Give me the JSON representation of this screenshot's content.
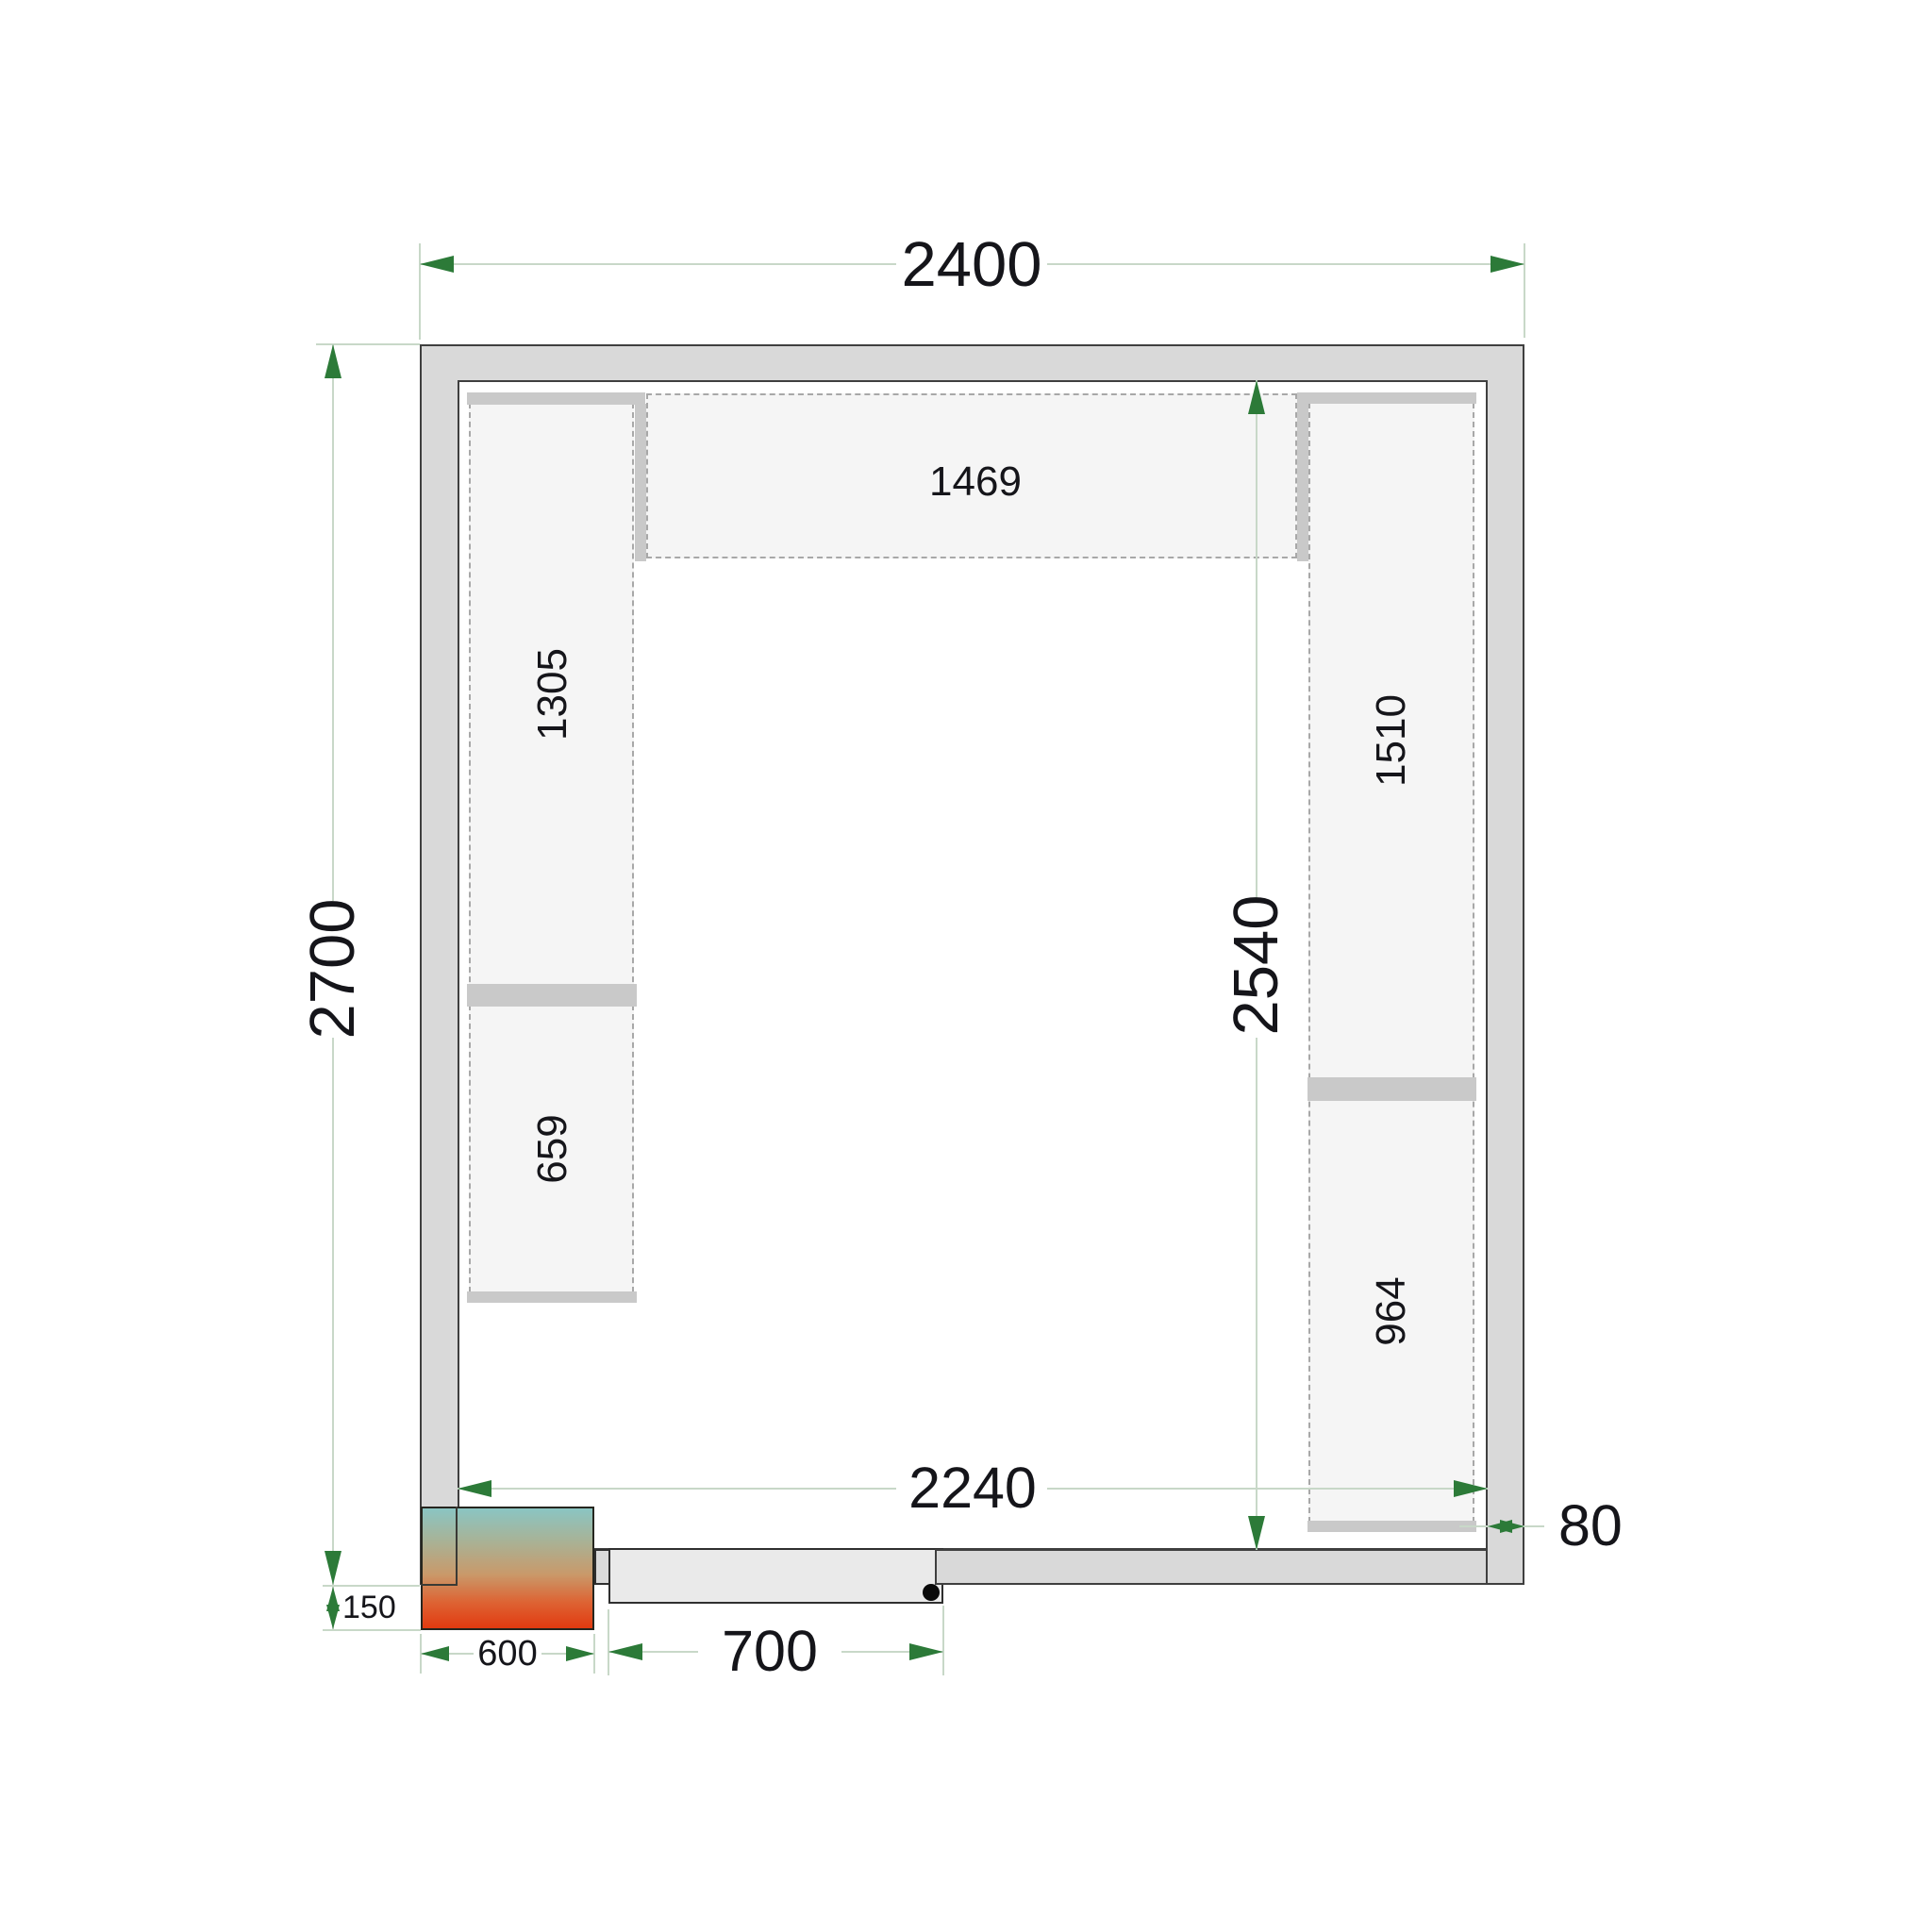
{
  "dimensions": {
    "outer_width": "2400",
    "outer_height": "2700",
    "interior_width": "2240",
    "interior_height": "2540",
    "wall_thickness": "80",
    "door_clear_width": "700",
    "cooling_unit_width": "600",
    "cooling_unit_offset": "150"
  },
  "shelves": {
    "top_length": "1469",
    "left_upper_length": "1305",
    "left_lower_length": "659",
    "right_upper_length": "1510",
    "right_lower_length": "964"
  },
  "colors": {
    "wall_fill": "#d9d9d9",
    "shelf_fill": "#f5f5f5",
    "shelf_cap_fill": "#c9c9c9",
    "dimension_line": "#c8d8c8",
    "arrow_green": "#2c7a38",
    "text": "#15151a",
    "cooler_gradient_top": "#8ac5c3",
    "cooler_gradient_bottom": "#e23a10",
    "door_leaf_fill": "#eaeaea"
  }
}
